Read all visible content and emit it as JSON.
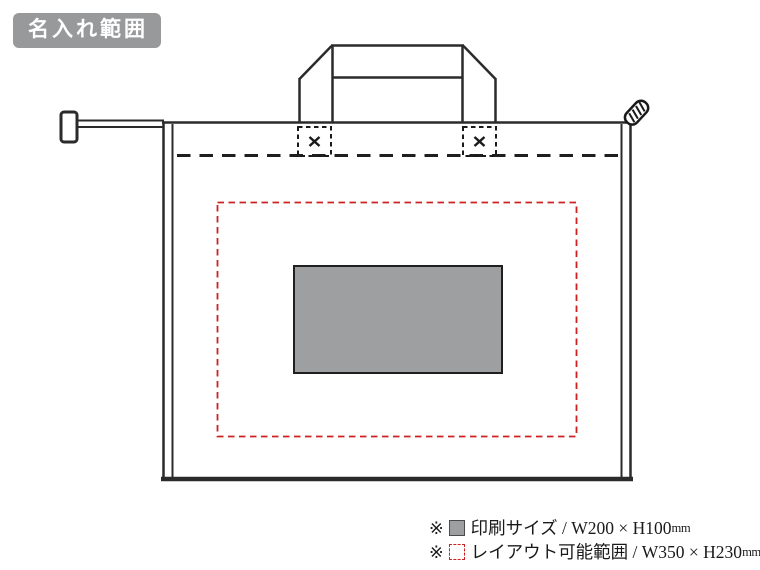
{
  "badge": {
    "label": "名入れ範囲"
  },
  "diagram": {
    "description": "tote-bag-print-area-diagram",
    "colors": {
      "line": "#2b2b2b",
      "badge_bg": "#98999b",
      "print_area_fill": "#9e9fa0",
      "layout_range_dash": "#cc2222"
    }
  },
  "legend": {
    "items": [
      {
        "mark": "※",
        "swatch": "print-size",
        "label": "印刷サイズ / W200 × H100",
        "unit": "mm"
      },
      {
        "mark": "※",
        "swatch": "layout-range",
        "label": "レイアウト可能範囲 / W350 × H230",
        "unit": "mm"
      }
    ]
  }
}
